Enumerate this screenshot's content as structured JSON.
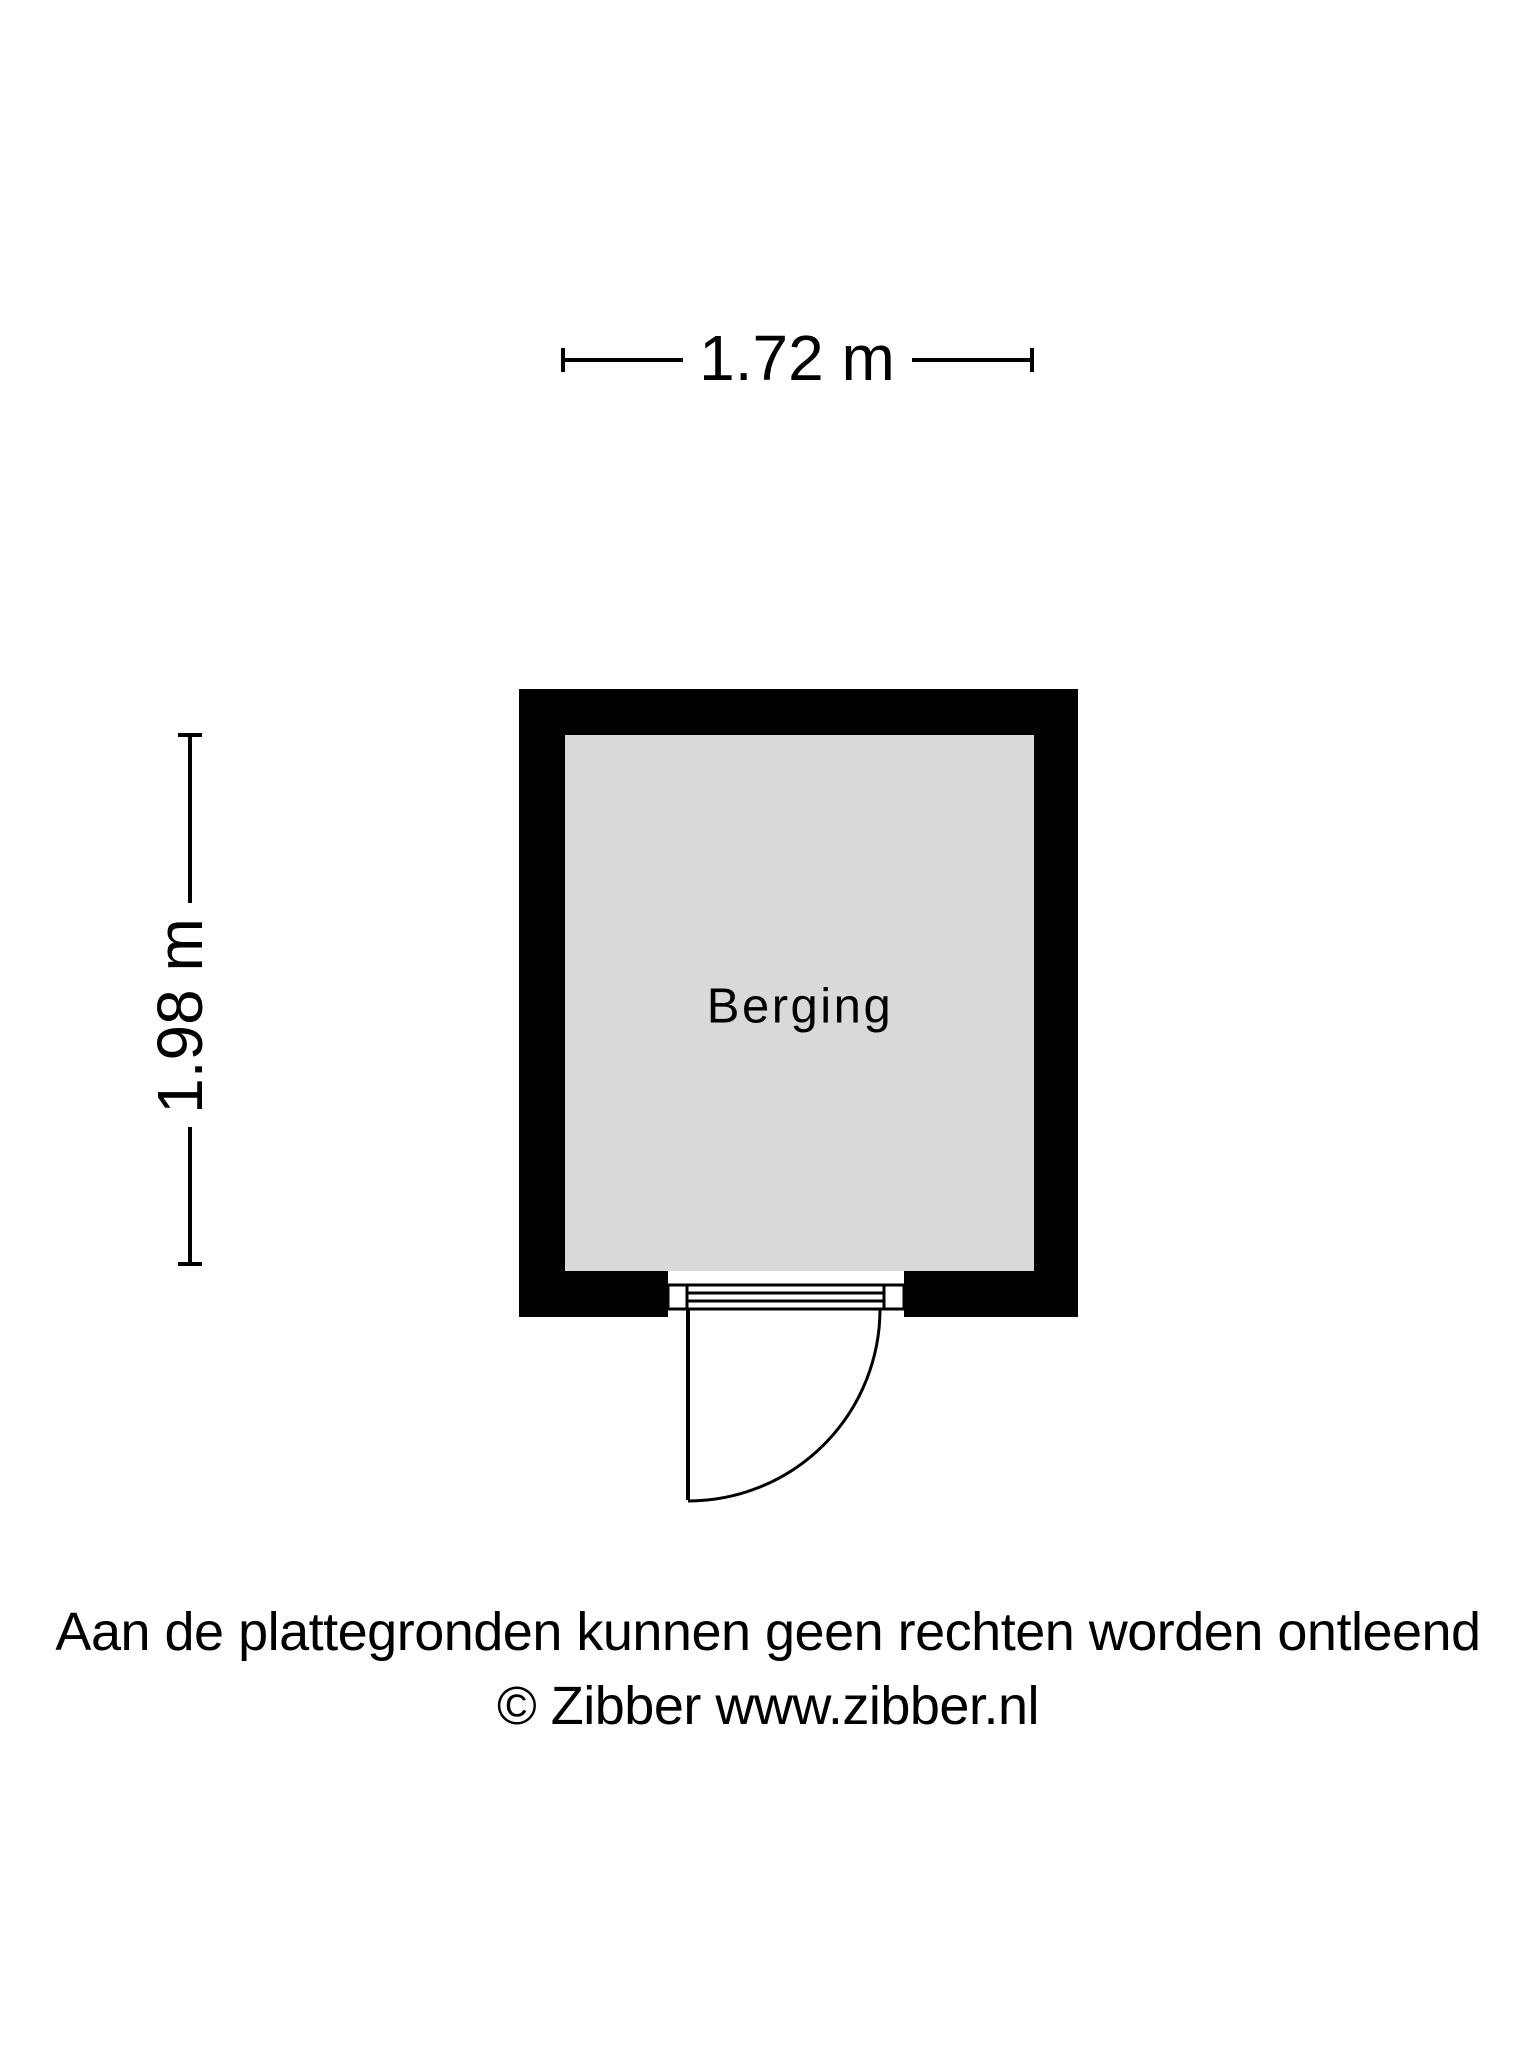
{
  "floorplan": {
    "room": {
      "label": "Berging",
      "wall_color": "#000000",
      "floor_color": "#d9d9d9"
    },
    "dimensions": {
      "width": "1.72 m",
      "height": "1.98 m"
    },
    "footer": {
      "disclaimer": "Aan de plattegronden kunnen geen rechten worden ontleend",
      "credit": "© Zibber www.zibber.nl"
    }
  }
}
